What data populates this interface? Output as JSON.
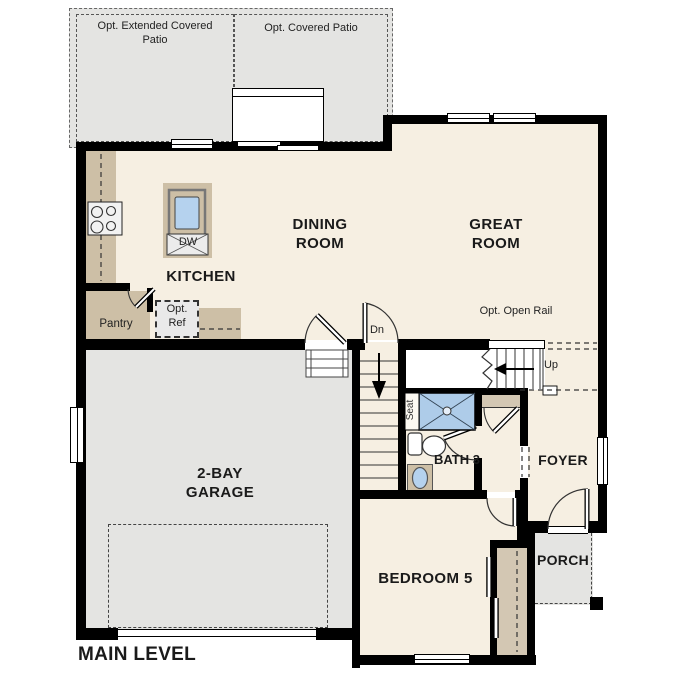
{
  "title": "MAIN LEVEL",
  "rooms": {
    "kitchen": "KITCHEN",
    "dining": "DINING ROOM",
    "great": "GREAT ROOM",
    "garage": "2-BAY GARAGE",
    "bedroom": "BEDROOM 5",
    "bath": "BATH 3",
    "foyer": "FOYER",
    "porch": "PORCH"
  },
  "outdoor": {
    "patio_extended": "Opt. Extended Covered Patio",
    "patio_covered": "Opt. Covered Patio"
  },
  "kitchen_features": {
    "pantry": "Pantry",
    "opt_ref": "Opt. Ref",
    "dishwasher": "DW"
  },
  "stairs": {
    "down": "Dn",
    "up": "Up",
    "opt_open_rail": "Opt. Open Rail"
  },
  "bath_features": {
    "seat": "Seat"
  },
  "colors": {
    "floor": "#f6efe2",
    "outdoor_concrete": "#e4e4e2",
    "counter": "#cdbfa6",
    "closet_shelf": "#d3c7b3",
    "water_fixture_blue": "#aecce9",
    "appliance_gray": "#ececec",
    "wall": "#000000"
  }
}
